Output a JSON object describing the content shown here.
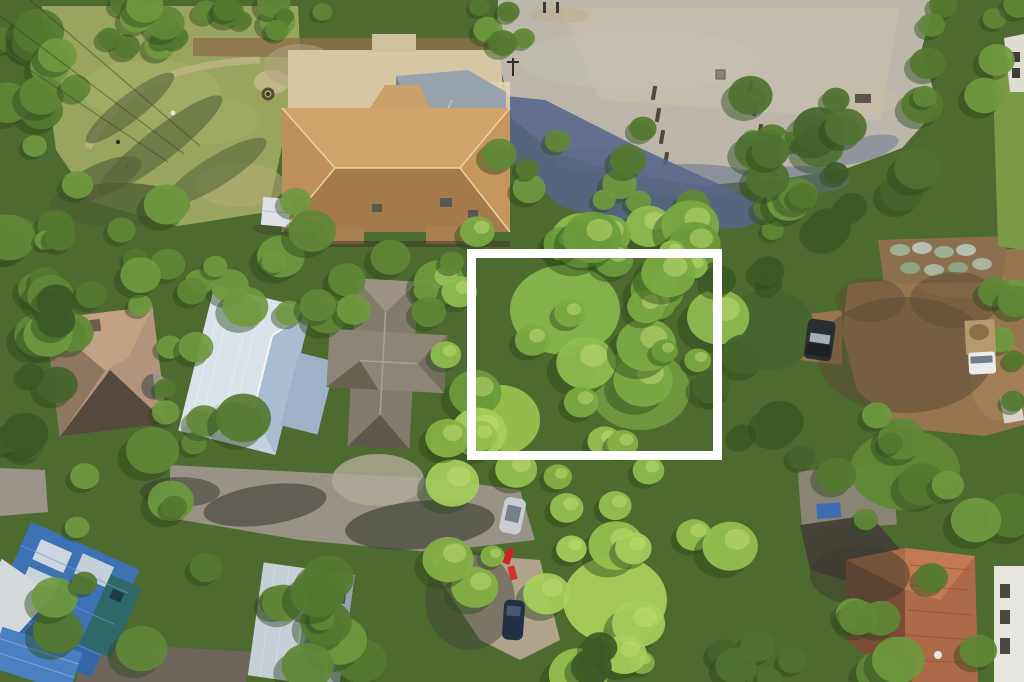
{
  "scene": {
    "type": "aerial-drone-photograph",
    "description": "Wooded residential neighborhood seen from directly overhead; a vacant tree-covered lot is highlighted with a white rectangular outline; tan hip-roof clubhouse and gravel parking lot at top; metal- and shingle-roof houses left and bottom; dirt road and parked vehicles at right"
  },
  "lot_outline": {
    "x": 471.5,
    "y": 253.5,
    "width": 246,
    "height": 202,
    "stroke": "#ffffff",
    "stroke_width": 9
  },
  "colors": {
    "canopy_base": "#4d6b2f",
    "lawn": "#99a55e",
    "lawn_dry": "#b3aa75",
    "pine_straw": "#8f6f4b",
    "gravel_lot": "#bcb7aa",
    "gravel_light": "#cec6ae",
    "dirt_road": "#97764f",
    "dirt_light": "#ab8a60",
    "concrete_drive": "#999287",
    "clearing": "#b0a58c",
    "paver_drive": "#6e665c",
    "pad_concrete": "#d6c6a3",
    "clubhouse_roof": "#c6965f",
    "shadow_blue": "#55658a",
    "metal_white_roof": "#dbe3ea",
    "shingle_gray_roof": "#837b6c",
    "shingle_tan_roof": "#b2937b",
    "metal_gray_roof": "#c6cfd6",
    "house_blue_roof": "#3e72b4",
    "tile_red_roof": "#ad6a48",
    "white_building": "#e7e5df",
    "tree_shadow": "#2c4a1d",
    "tree_highlight": "#c2dd76",
    "tree_palettes": {
      "bright": [
        "#7cab43",
        "#8fbe4f",
        "#6d9c3c"
      ],
      "mid": [
        "#5f8836",
        "#6f9940",
        "#54792f"
      ],
      "dark": [
        "#44652c",
        "#3a5a26",
        "#4e7231"
      ],
      "lime": [
        "#96c24f",
        "#a6cf5b",
        "#85b244"
      ]
    }
  },
  "landmarks": [
    "highlighted-vacant-lot",
    "clubhouse-tan-hip-roof",
    "gravel-parking-lot",
    "lawn-green-space",
    "white-metal-roof-house",
    "gray-shingle-roof-house",
    "tan-shingle-roof-house-with-turret",
    "blue-metal-roof-house",
    "gray-metal-roof-house",
    "red-tile-roof-house",
    "dirt-road",
    "concrete-driveway",
    "dark-suv",
    "white-flatbed-truck",
    "silver-car",
    "dark-blue-car",
    "red-kayaks"
  ]
}
